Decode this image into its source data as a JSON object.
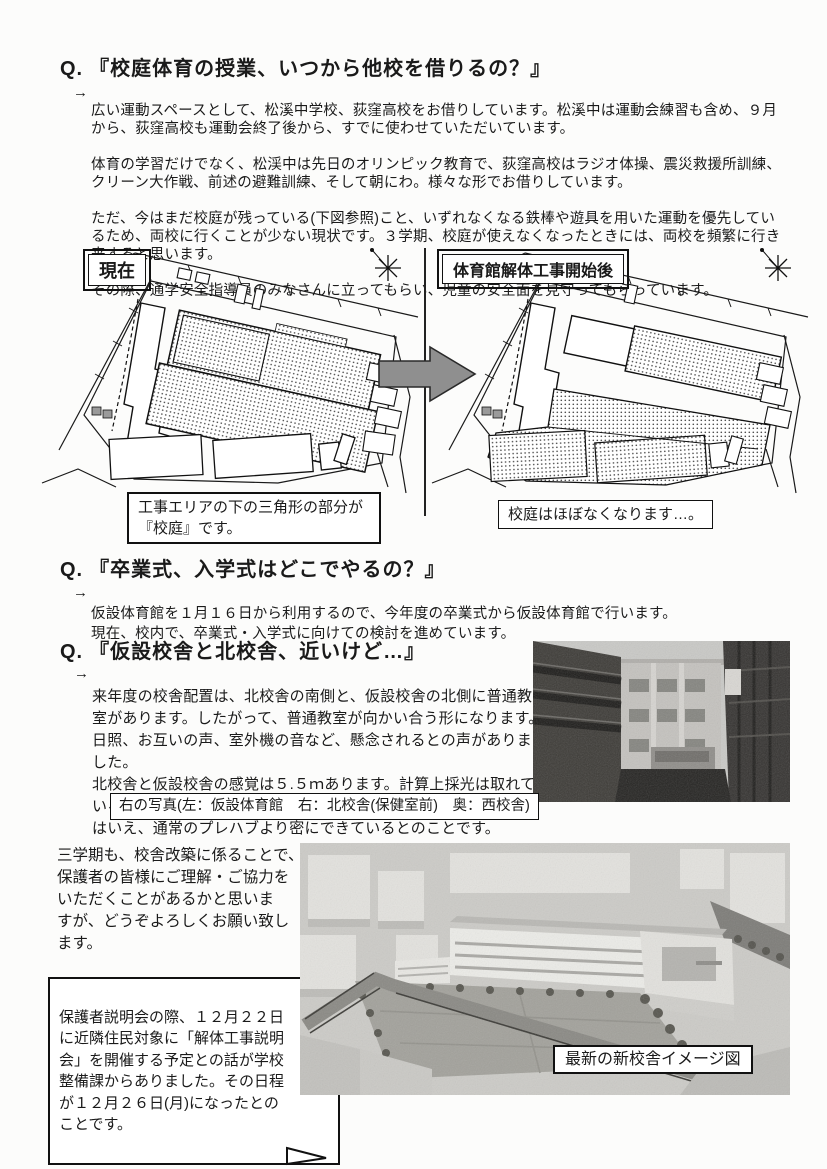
{
  "page": {
    "background": "#fcfcfb",
    "text_color": "#1a1a1a"
  },
  "q1": {
    "q_label": "Q.",
    "title": "『校庭体育の授業、いつから他校を借りるの？』",
    "arrow": "→",
    "para1": "広い運動スペースとして、松溪中学校、荻窪高校をお借りしています。松溪中は運動会練習も含め、９月\nから、荻窪高校も運動会終了後から、すでに使わせていただいています。",
    "para2": "体育の学習だけでなく、松渓中は先日のオリンピック教育で、荻窪高校はラジオ体操、震災救援所訓練、\nクリーン大作戦、前述の避難訓練、そして朝にわ。様々な形でお借りしています。",
    "para3": "ただ、今はまだ校庭が残っている(下図参照)こと、いずれなくなる鉄棒や遊具を用いた運動を優先してい\nるため、両校に行くことが少ない現状です。３学期、校庭が使えなくなったときには、両校を頻繁に行き\n来すると思います。",
    "para4": "その際、通学安全指導員のみなさんに立ってもらい、児童の安全面を見守ってもらっています。"
  },
  "figure": {
    "left_label": "現在",
    "right_label": "体育館解体工事開始後",
    "left_caption": "工事エリアの下の三角形の部分が\n『校庭』です。",
    "right_caption": "校庭はほぼなくなります…。",
    "arrow_color": "#8f8f8f",
    "icons": {
      "compass": "compass-star-icon",
      "transition": "arrow-right-icon"
    }
  },
  "q2": {
    "q_label": "Q.",
    "title": "『卒業式、入学式はどこでやるの？』",
    "arrow": "→",
    "para1": "仮設体育館を１月１６日から利用するので、今年度の卒業式から仮設体育館で行います。\n現在、校内で、卒業式・入学式に向けての検討を進めています。"
  },
  "q3": {
    "q_label": "Q.",
    "title": "『仮設校舎と北校舎、近いけど…』",
    "arrow": "→",
    "para1": "来年度の校舎配置は、北校舎の南側と、仮設校舎の北側に普通教\n室があります。したがって、普通教室が向かい合う形になります。\n日照、お互いの声、室外機の音など、懸念されるとの声がありま\nした。\n北校舎と仮設校舎の感覚は５.５ｍあります。計算上採光は取れて\nいるとのことです。また、音については、仮設校舎はプレハブと\nはいえ、通常のプレハブより密にできているとのことです。",
    "photo_caption": "右の写真(左：仮設体育館　右：北校舎(保健室前)　奥：西校舎)"
  },
  "closing": {
    "para": "三学期も、校舎改築に係ることで、\n保護者の皆様にご理解・ご協力を\nいただくことがあるかと思いま\nすが、どうぞよろしくお願い致し\nます。",
    "note": "保護者説明会の際、１２月２２日\nに近隣住民対象に「解体工事説明\n会」を開催する予定との話が学校\n整備課からありました。その日程\nが１２月２６日(月)になったとの\nことです。",
    "photo_caption": "最新の新校舎イメージ図"
  }
}
